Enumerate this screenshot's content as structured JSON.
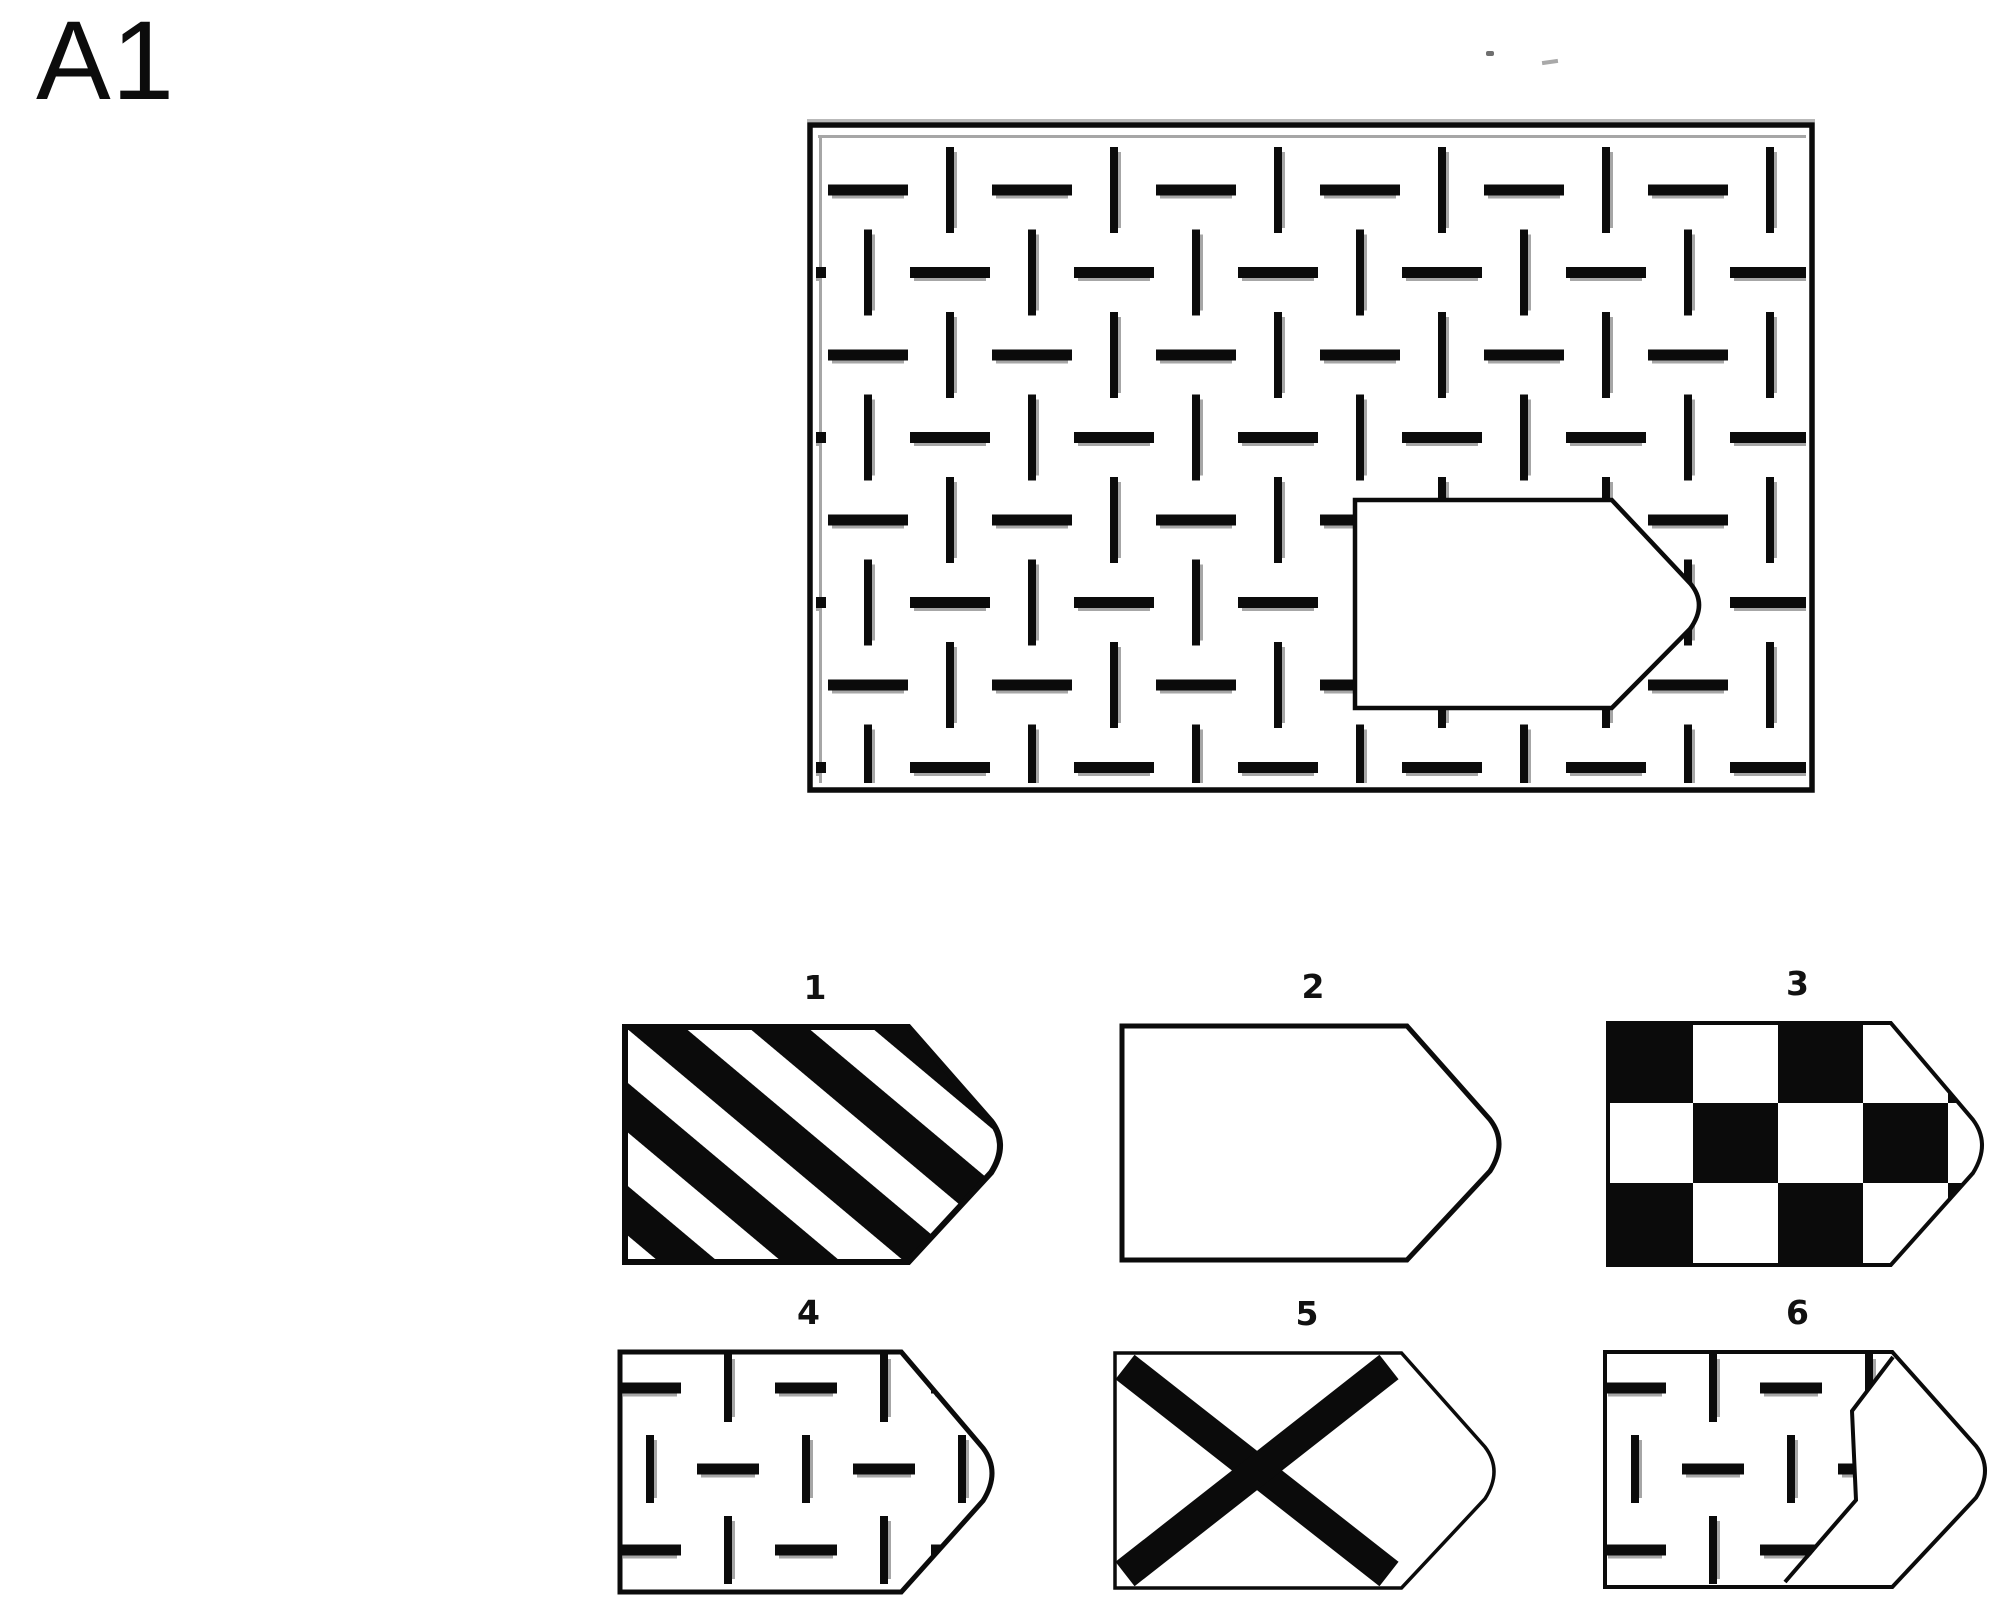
{
  "item_label": "A1",
  "stimulus": {
    "name": "pattern-matrix",
    "pattern": "basket-weave",
    "cutout_shape": "rounded-tag-pointing-right",
    "cutout_fill": "blank"
  },
  "options": [
    {
      "number": "1",
      "pattern": "diagonal-stripes"
    },
    {
      "number": "2",
      "pattern": "blank"
    },
    {
      "number": "3",
      "pattern": "checkerboard"
    },
    {
      "number": "4",
      "pattern": "basket-weave"
    },
    {
      "number": "5",
      "pattern": "x-cross"
    },
    {
      "number": "6",
      "pattern": "basket-weave-offset"
    }
  ],
  "colors": {
    "ink": "#0b0b0b",
    "shadow": "#a6a6a6",
    "background": "#ffffff"
  }
}
